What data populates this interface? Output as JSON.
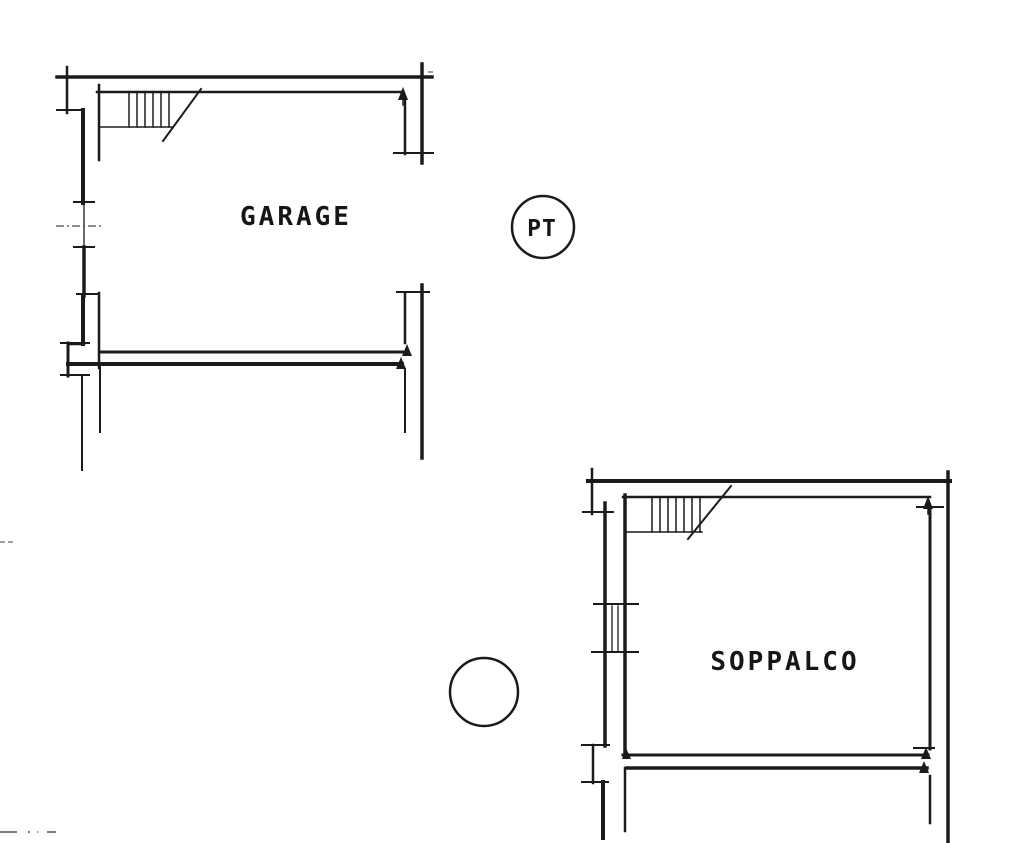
{
  "page": {
    "background": "#ffffff",
    "ink_color": "#1b1b1b",
    "drawing_type": "floor plan"
  },
  "plans": [
    {
      "id": "garage",
      "label": "GARAGE"
    },
    {
      "id": "soppalco",
      "label": "SOPPALCO"
    }
  ],
  "badges": [
    {
      "id": "floor-level",
      "label": "PT"
    },
    {
      "id": "upper-level",
      "label": ""
    }
  ]
}
